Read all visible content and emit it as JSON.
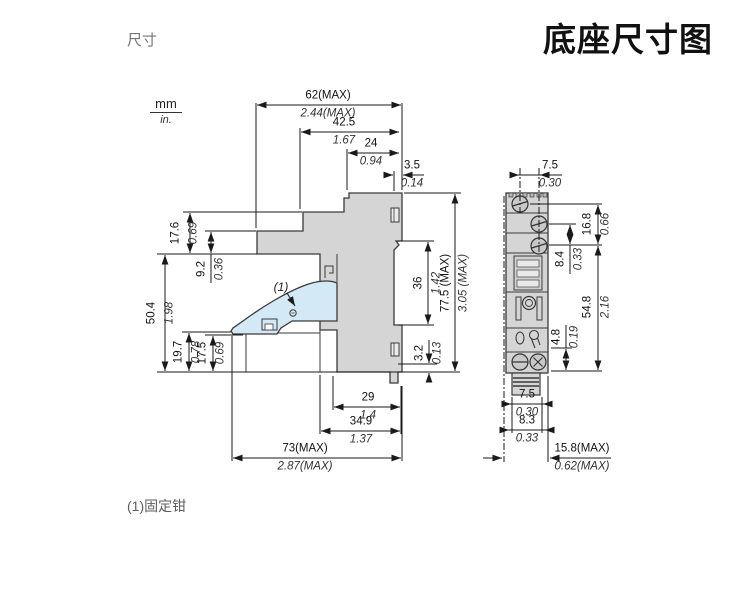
{
  "page": {
    "title": "底座尺寸图",
    "section_label": "尺寸",
    "footnote": "(1)固定钳",
    "callout_label": "(1)"
  },
  "units": {
    "mm": "mm",
    "in": "in."
  },
  "colors": {
    "body_fill": "#d5d5d5",
    "clamp_fill": "#d3e9f6",
    "outline": "#3a3a3a",
    "dim_line": "#1a1a1a",
    "gray_text": "#767676"
  },
  "side_view": {
    "name": "side profile with DIN-rail clamp",
    "dims": {
      "w62": {
        "mm": "62(MAX)",
        "in": "2.44(MAX)"
      },
      "w42_5": {
        "mm": "42.5",
        "in": "1.67"
      },
      "w24": {
        "mm": "24",
        "in": "0.94"
      },
      "w3_5": {
        "mm": "3.5",
        "in": "0.14"
      },
      "h17_6": {
        "mm": "17.6",
        "in": "0.69"
      },
      "h9_2": {
        "mm": "9.2",
        "in": "0.36"
      },
      "h50_4": {
        "mm": "50.4",
        "in": "1.98"
      },
      "h19_7": {
        "mm": "19.7",
        "in": "0.78"
      },
      "h17_5": {
        "mm": "17.5",
        "in": "0.69"
      },
      "h36": {
        "mm": "36",
        "in": "1.42"
      },
      "h77_5": {
        "mm": "77.5 (MAX)",
        "in": "3.05 (MAX)"
      },
      "h3_2": {
        "mm": "3.2",
        "in": "0.13"
      },
      "w29": {
        "mm": "29",
        "in": "1.4"
      },
      "w34_9": {
        "mm": "34.9",
        "in": "1.37"
      },
      "w73": {
        "mm": "73(MAX)",
        "in": "2.87(MAX)"
      }
    }
  },
  "front_view": {
    "name": "front face with screw terminals",
    "dims": {
      "w7_5_top": {
        "mm": "7.5",
        "in": "0.30"
      },
      "h16_8": {
        "mm": "16.8",
        "in": "0.66"
      },
      "h8_4": {
        "mm": "8.4",
        "in": "0.33"
      },
      "h54_8": {
        "mm": "54.8",
        "in": "2.16"
      },
      "h4_8": {
        "mm": "4.8",
        "in": "0.19"
      },
      "w7_5_bottom": {
        "mm": "7.5",
        "in": "0.30"
      },
      "w8_3": {
        "mm": "8.3",
        "in": "0.33"
      },
      "w15_8": {
        "mm": "15.8(MAX)",
        "in": "0.62(MAX)"
      }
    }
  }
}
